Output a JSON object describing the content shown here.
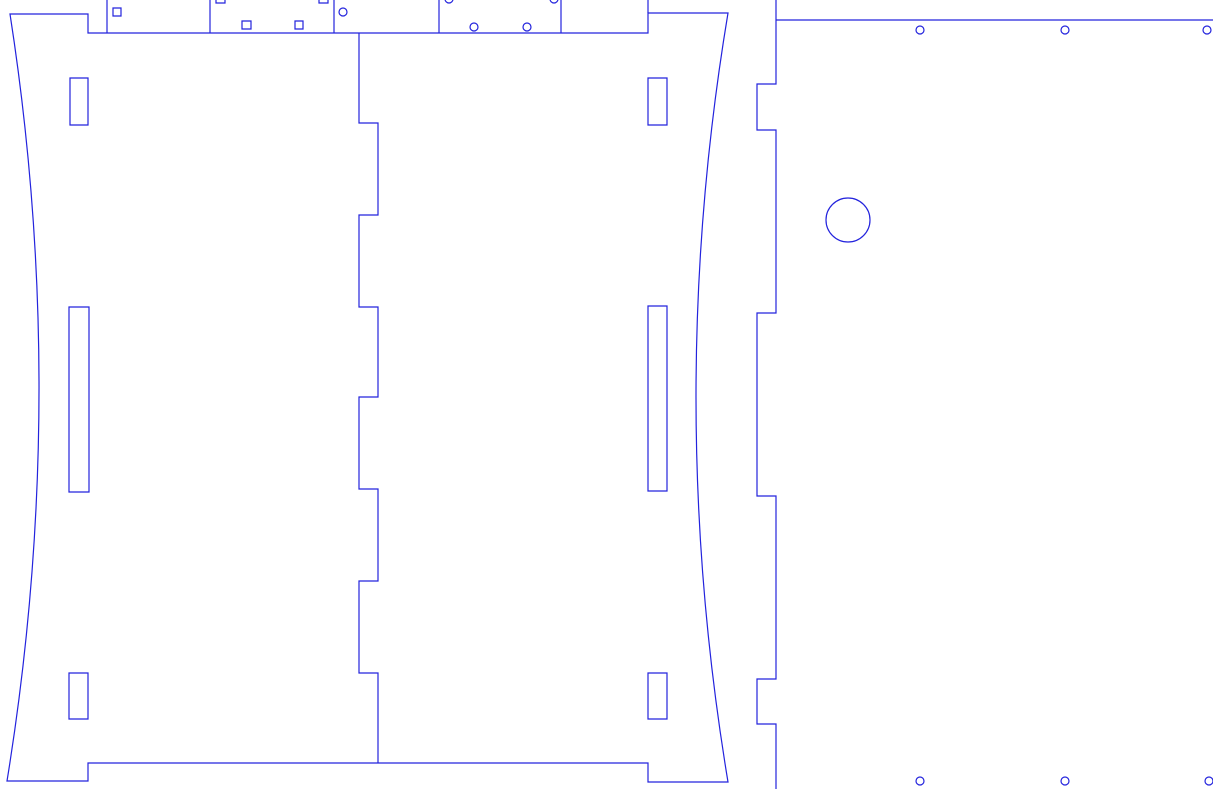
{
  "canvas": {
    "width": 1213,
    "height": 789,
    "background_color": "#ffffff",
    "stroke_color": "#2323dd",
    "stroke_width": 1.2,
    "fill": "none"
  },
  "shapes": [
    {
      "name": "top-strip-divider-1",
      "type": "line",
      "attrs": {
        "x1": 107,
        "y1": 0,
        "x2": 107,
        "y2": 33
      }
    },
    {
      "name": "top-strip-divider-2",
      "type": "line",
      "attrs": {
        "x1": 210,
        "y1": 0,
        "x2": 210,
        "y2": 33
      }
    },
    {
      "name": "top-strip-divider-3",
      "type": "line",
      "attrs": {
        "x1": 334,
        "y1": 0,
        "x2": 334,
        "y2": 33
      }
    },
    {
      "name": "top-strip-divider-4",
      "type": "line",
      "attrs": {
        "x1": 439,
        "y1": 0,
        "x2": 439,
        "y2": 33
      }
    },
    {
      "name": "top-strip-divider-5",
      "type": "line",
      "attrs": {
        "x1": 561,
        "y1": 0,
        "x2": 561,
        "y2": 33
      }
    },
    {
      "name": "top-strip-divider-6",
      "type": "line",
      "attrs": {
        "x1": 648,
        "y1": 0,
        "x2": 648,
        "y2": 13
      }
    },
    {
      "name": "square-hole-1",
      "type": "rect",
      "attrs": {
        "x": 113,
        "y": 8,
        "width": 8,
        "height": 8
      }
    },
    {
      "name": "square-hole-2-clipped",
      "type": "rect",
      "attrs": {
        "x": 216,
        "y": -5,
        "width": 9,
        "height": 8
      }
    },
    {
      "name": "square-hole-3-clipped",
      "type": "rect",
      "attrs": {
        "x": 319,
        "y": -5,
        "width": 9,
        "height": 8
      }
    },
    {
      "name": "square-hole-4",
      "type": "rect",
      "attrs": {
        "x": 242,
        "y": 21,
        "width": 9,
        "height": 8
      }
    },
    {
      "name": "square-hole-5",
      "type": "rect",
      "attrs": {
        "x": 295,
        "y": 21,
        "width": 8,
        "height": 8
      }
    },
    {
      "name": "circle-hole-1",
      "type": "circle",
      "attrs": {
        "cx": 343,
        "cy": 12,
        "r": 4
      }
    },
    {
      "name": "circle-hole-2-clipped",
      "type": "circle",
      "attrs": {
        "cx": 449,
        "cy": -1,
        "r": 4
      }
    },
    {
      "name": "circle-hole-3-clipped",
      "type": "circle",
      "attrs": {
        "cx": 554,
        "cy": -1,
        "r": 4
      }
    },
    {
      "name": "circle-hole-4",
      "type": "circle",
      "attrs": {
        "cx": 474,
        "cy": 27,
        "r": 4
      }
    },
    {
      "name": "circle-hole-5",
      "type": "circle",
      "attrs": {
        "cx": 527,
        "cy": 27,
        "r": 4
      }
    },
    {
      "name": "side-panels-outline",
      "type": "path",
      "attrs": {
        "d": "M 7 781 Q 69.5 397 10 14 L 88 14 L 88 33 L 648 33 L 648 13 L 728 13 Q 664 397 728 782 L 648 782 L 648 763 L 88 763 L 88 781 Z"
      }
    },
    {
      "name": "finger-joint-edge",
      "type": "path",
      "attrs": {
        "d": "M 359 33 L 359 123 L 378 123 L 378 215 L 359 215 L 359 307 L 378 307 L 378 397 L 359 397 L 359 489 L 378 489 L 378 581 L 359 581 L 359 673 L 378 673 L 378 763"
      }
    },
    {
      "name": "slot-left-top",
      "type": "rect",
      "attrs": {
        "x": 70,
        "y": 78,
        "width": 18,
        "height": 47
      }
    },
    {
      "name": "slot-left-middle",
      "type": "rect",
      "attrs": {
        "x": 69,
        "y": 307,
        "width": 20,
        "height": 185
      }
    },
    {
      "name": "slot-left-bottom",
      "type": "rect",
      "attrs": {
        "x": 69,
        "y": 673,
        "width": 19,
        "height": 46
      }
    },
    {
      "name": "slot-right-top",
      "type": "rect",
      "attrs": {
        "x": 648,
        "y": 78,
        "width": 19,
        "height": 47
      }
    },
    {
      "name": "slot-right-middle",
      "type": "rect",
      "attrs": {
        "x": 648,
        "y": 306,
        "width": 19,
        "height": 185
      }
    },
    {
      "name": "slot-right-bottom",
      "type": "rect",
      "attrs": {
        "x": 648,
        "y": 673,
        "width": 19,
        "height": 46
      }
    },
    {
      "name": "back-panel-left-edge",
      "type": "path",
      "attrs": {
        "d": "M 776 0 L 776 84 L 757 84 L 757 130 L 776 130 L 776 313 L 757 313 L 757 496 L 776 496 L 776 679 L 757 679 L 757 724 L 776 724 L 776 789"
      }
    },
    {
      "name": "back-panel-top-edge",
      "type": "line",
      "attrs": {
        "x1": 776,
        "y1": 20,
        "x2": 1213,
        "y2": 20
      }
    },
    {
      "name": "large-circle-cutout",
      "type": "circle",
      "attrs": {
        "cx": 848,
        "cy": 220,
        "r": 22
      }
    },
    {
      "name": "mounting-hole-top-1",
      "type": "circle",
      "attrs": {
        "cx": 920,
        "cy": 30,
        "r": 4
      }
    },
    {
      "name": "mounting-hole-top-2",
      "type": "circle",
      "attrs": {
        "cx": 1065,
        "cy": 30,
        "r": 4
      }
    },
    {
      "name": "mounting-hole-top-3",
      "type": "circle",
      "attrs": {
        "cx": 1207,
        "cy": 30,
        "r": 4
      }
    },
    {
      "name": "mounting-hole-bottom-1",
      "type": "circle",
      "attrs": {
        "cx": 920,
        "cy": 781,
        "r": 4
      }
    },
    {
      "name": "mounting-hole-bottom-2",
      "type": "circle",
      "attrs": {
        "cx": 1065,
        "cy": 781,
        "r": 4
      }
    },
    {
      "name": "mounting-hole-bottom-3",
      "type": "circle",
      "attrs": {
        "cx": 1209,
        "cy": 781,
        "r": 4
      }
    }
  ]
}
